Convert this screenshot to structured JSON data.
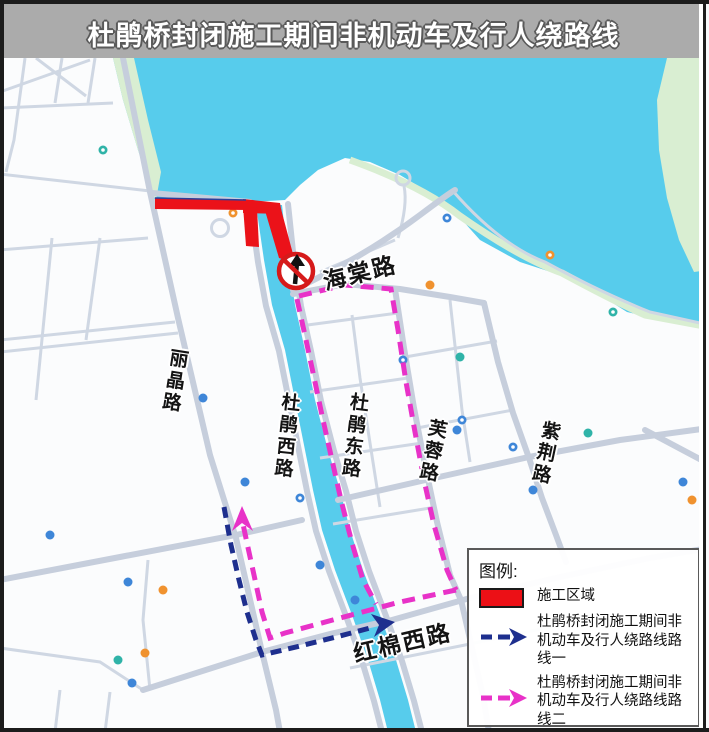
{
  "title_bar": {
    "title": "杜鹃桥封闭施工期间非机动车及行人绕路线"
  },
  "map": {
    "road_labels": {
      "haitang": "海棠路",
      "lijing": "丽晶路",
      "dujuan_west": "杜鹃西路",
      "dujuan_east": "杜鹃东路",
      "furong": "芙蓉路",
      "zijing": "紫荆路",
      "hongmian_west": "红棉西路"
    }
  },
  "legend": {
    "title": "图例:",
    "items": [
      {
        "label": "施工区域"
      },
      {
        "label": "杜鹃桥封闭施工期间非机动车及行人绕路线路线一"
      },
      {
        "label": "杜鹃桥封闭施工期间非机动车及行人绕路线路线二"
      }
    ]
  },
  "colors": {
    "water": "#57ccec",
    "shore_green": "#d9eed2",
    "construction_red": "#eb1219",
    "route_one_navy": "#1e2f8e",
    "route_two_magenta": "#e832c8",
    "road_gray": "#c6cedc",
    "title_bar_bg": "#ababab"
  }
}
